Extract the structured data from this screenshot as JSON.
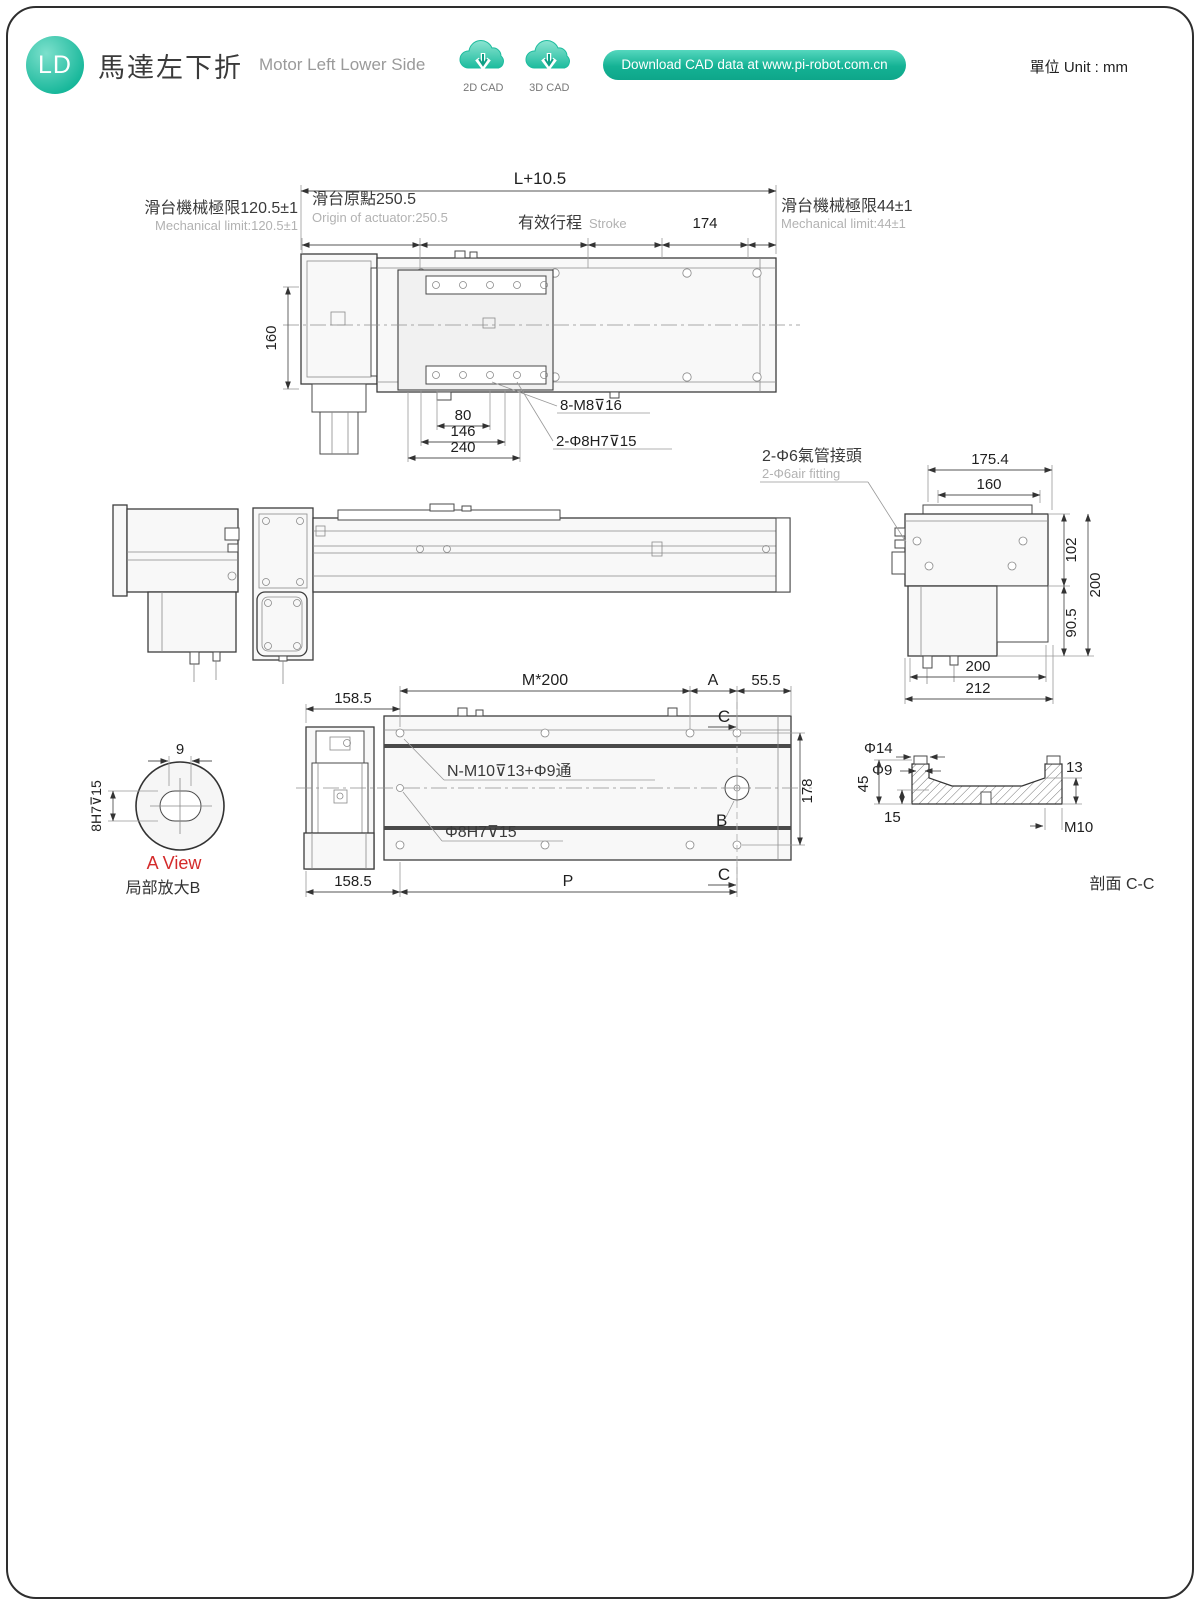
{
  "header": {
    "badge": "LD",
    "title_zh": "馬達左下折",
    "title_en": "Motor Left Lower Side",
    "cad_2d_label": "2D CAD",
    "cad_3d_label": "3D CAD",
    "download_text": "Download CAD data at www.pi-robot.com.cn",
    "unit_text": "單位 Unit : mm"
  },
  "colors": {
    "teal": "#1abca0",
    "mint": "#def2ed",
    "red": "#d42b2b"
  },
  "top_view": {
    "dim_overall": "L+10.5",
    "mech_limit_left_zh": "滑台機械極限120.5±1",
    "mech_limit_left_en": "Mechanical limit:120.5±1",
    "origin_zh": "滑台原點250.5",
    "origin_en": "Origin of actuator:250.5",
    "stroke_zh": "有效行程",
    "stroke_en": "Stroke",
    "dim_174": "174",
    "mech_limit_right_zh": "滑台機械極限44±1",
    "mech_limit_right_en": "Mechanical limit:44±1",
    "dim_160": "160",
    "dim_80": "80",
    "dim_146": "146",
    "dim_240": "240",
    "label_screws": "8-M8⊽16",
    "label_pins": "2-Φ8H7⊽15"
  },
  "side_view": {
    "air_zh": "2-Φ6氣管接頭",
    "air_en": "2-Φ6air fitting",
    "dim_175_4": "175.4",
    "dim_160": "160",
    "dim_102": "102",
    "dim_200_right": "200",
    "dim_90_5": "90.5",
    "dim_200_bottom": "200",
    "dim_212": "212"
  },
  "bottom_view": {
    "dim_158_5_top": "158.5",
    "dim_m200": "M*200",
    "label_a": "A",
    "dim_55_5": "55.5",
    "label_c": "C",
    "label_nm10": "N-M10⊽13+Φ9通",
    "label_phi8": "Φ8H7⊽15",
    "label_b": "B",
    "dim_178": "178",
    "dim_158_5_bottom": "158.5",
    "dim_p": "P"
  },
  "a_view": {
    "dim_9": "9",
    "dim_8h7": "8H7⊽15",
    "title": "A View",
    "subtitle": "局部放大B"
  },
  "section_cc": {
    "dim_phi14": "Φ14",
    "dim_phi9": "Φ9",
    "dim_45": "45",
    "dim_15": "15",
    "dim_13": "13",
    "dim_m10": "M10",
    "title": "剖面 C-C"
  },
  "tables": [
    {
      "header_label_zh": "有效行程",
      "header_label_en": "Stroke",
      "strokes": [
        100,
        150,
        200,
        250,
        300,
        350,
        400,
        450,
        500,
        550,
        600,
        650,
        700,
        750,
        800,
        850,
        900,
        950,
        1000,
        1050,
        1100,
        1150,
        1200,
        1250
      ],
      "rows": [
        {
          "label": "L",
          "values": [
            514,
            564,
            614,
            664,
            714,
            764,
            814,
            864,
            914,
            964,
            1014,
            1064,
            1114,
            1164,
            1214,
            1264,
            1314,
            1364,
            1414,
            1464,
            1514,
            1564,
            1614,
            1664
          ]
        },
        {
          "label": "A",
          "values": [
            100,
            150,
            200,
            50,
            100,
            150,
            200,
            50,
            100,
            150,
            200,
            50,
            100,
            150,
            200,
            50,
            100,
            150,
            200,
            50,
            100,
            150,
            200,
            50
          ]
        },
        {
          "label": "M",
          "values": [
            1,
            1,
            1,
            2,
            2,
            2,
            2,
            3,
            3,
            3,
            3,
            4,
            4,
            4,
            4,
            5,
            5,
            5,
            5,
            6,
            6,
            6,
            6,
            7
          ]
        },
        {
          "label": "N",
          "values": [
            6,
            6,
            6,
            8,
            8,
            8,
            8,
            10,
            10,
            10,
            10,
            12,
            12,
            12,
            12,
            14,
            14,
            14,
            14,
            16,
            16,
            16,
            16,
            18
          ]
        },
        {
          "label": "P",
          "values": [
            300,
            350,
            400,
            450,
            500,
            550,
            600,
            650,
            700,
            750,
            800,
            850,
            900,
            950,
            1000,
            1050,
            1100,
            1150,
            1200,
            1250,
            1300,
            1350,
            1400,
            1450
          ]
        },
        {
          "label": "KG",
          "values": [
            16.6,
            17.3,
            17.9,
            18.6,
            19.2,
            19.9,
            20.6,
            21.2,
            21.9,
            22.6,
            23.2,
            23.9,
            24.6,
            25.2,
            25.9,
            26.6,
            27.2,
            27.9,
            28.6,
            29.2,
            29.9,
            30.5,
            31.2,
            31.9
          ]
        }
      ]
    },
    {
      "header_label_zh": "有效行程",
      "header_label_en": "Stroke",
      "strokes": [
        1300,
        1350,
        1400,
        1450,
        1500,
        1550,
        1600,
        1650,
        1700,
        1750,
        1800,
        1850,
        1900,
        1950,
        2000,
        2050,
        2100,
        2150,
        2200,
        2250,
        2300,
        2350,
        2400,
        2450
      ],
      "rows": [
        {
          "label": "L",
          "values": [
            1714,
            1764,
            1814,
            1864,
            1914,
            1964,
            2014,
            2064,
            2114,
            2164,
            2214,
            2264,
            2314,
            2364,
            2414,
            2464,
            2514,
            2564,
            2614,
            2664,
            2714,
            2764,
            2814,
            2864
          ]
        },
        {
          "label": "A",
          "values": [
            100,
            150,
            200,
            50,
            100,
            150,
            200,
            50,
            100,
            150,
            200,
            50,
            100,
            150,
            200,
            50,
            100,
            150,
            200,
            50,
            100,
            150,
            200,
            50
          ]
        },
        {
          "label": "M",
          "values": [
            7,
            7,
            7,
            8,
            8,
            8,
            8,
            9,
            9,
            9,
            9,
            10,
            10,
            10,
            10,
            11,
            11,
            11,
            11,
            12,
            12,
            12,
            12,
            13
          ]
        },
        {
          "label": "N",
          "values": [
            18,
            18,
            18,
            20,
            20,
            20,
            20,
            22,
            22,
            22,
            22,
            24,
            24,
            24,
            24,
            26,
            26,
            26,
            26,
            28,
            28,
            28,
            28,
            30
          ]
        },
        {
          "label": "P",
          "values": [
            1500,
            1550,
            1600,
            1650,
            1700,
            1750,
            1800,
            1850,
            1900,
            1950,
            2000,
            2050,
            2100,
            2150,
            2200,
            2250,
            2300,
            2350,
            2400,
            2450,
            2500,
            2550,
            2600,
            2650
          ]
        },
        {
          "label": "KG",
          "values": [
            32.5,
            33.2,
            33.9,
            34.5,
            35.2,
            35.8,
            36.5,
            37.2,
            37.9,
            38.5,
            39.2,
            39.8,
            40.5,
            41.2,
            41.8,
            42.5,
            43.2,
            43.8,
            44.5,
            45.2,
            45.8,
            46.5,
            47.2,
            47.8
          ]
        }
      ]
    },
    {
      "header_label_zh": "有效行程",
      "header_label_en": "Stroke",
      "strokes": [
        2500,
        2550,
        2600,
        2650,
        2700,
        2750,
        2800,
        2850,
        2900,
        2950,
        3000,
        3050,
        3100,
        3150,
        3200,
        3250,
        3300,
        3350,
        3400,
        3450,
        3500,
        3550,
        3600,
        3650
      ],
      "rows": [
        {
          "label": "L",
          "values": [
            2914,
            2964,
            3014,
            3064,
            3114,
            3164,
            3214,
            3264,
            3314,
            3364,
            3414,
            3464,
            3514,
            3564,
            3614,
            3664,
            3714,
            3764,
            3814,
            3864,
            3914,
            3964,
            4014,
            4064
          ]
        },
        {
          "label": "A",
          "values": [
            100,
            150,
            200,
            50,
            100,
            150,
            200,
            50,
            100,
            150,
            200,
            50,
            100,
            150,
            200,
            50,
            100,
            150,
            200,
            50,
            100,
            150,
            200,
            50
          ]
        },
        {
          "label": "M",
          "values": [
            13,
            13,
            13,
            14,
            14,
            14,
            14,
            15,
            15,
            15,
            15,
            16,
            16,
            16,
            16,
            17,
            17,
            17,
            17,
            18,
            18,
            18,
            18,
            19
          ]
        },
        {
          "label": "N",
          "values": [
            30,
            30,
            30,
            32,
            32,
            32,
            32,
            34,
            34,
            34,
            34,
            36,
            36,
            36,
            36,
            38,
            38,
            38,
            38,
            40,
            40,
            40,
            40,
            42
          ]
        },
        {
          "label": "P",
          "values": [
            2700,
            2750,
            2800,
            2850,
            2900,
            2950,
            3000,
            3050,
            3100,
            3150,
            3200,
            3250,
            3300,
            3350,
            3400,
            3450,
            3500,
            3550,
            3600,
            3650,
            3700,
            3750,
            3800,
            3850
          ]
        },
        {
          "label": "KG",
          "values": [
            48.5,
            49.2,
            49.8,
            50.5,
            51.1,
            51.8,
            52.5,
            53.1,
            53.8,
            54.5,
            55.1,
            55.8,
            56.5,
            57.1,
            57.8,
            58.5,
            59.1,
            59.8,
            60.4,
            61.1,
            61.8,
            62.4,
            63.1,
            63.8
          ]
        }
      ]
    }
  ]
}
